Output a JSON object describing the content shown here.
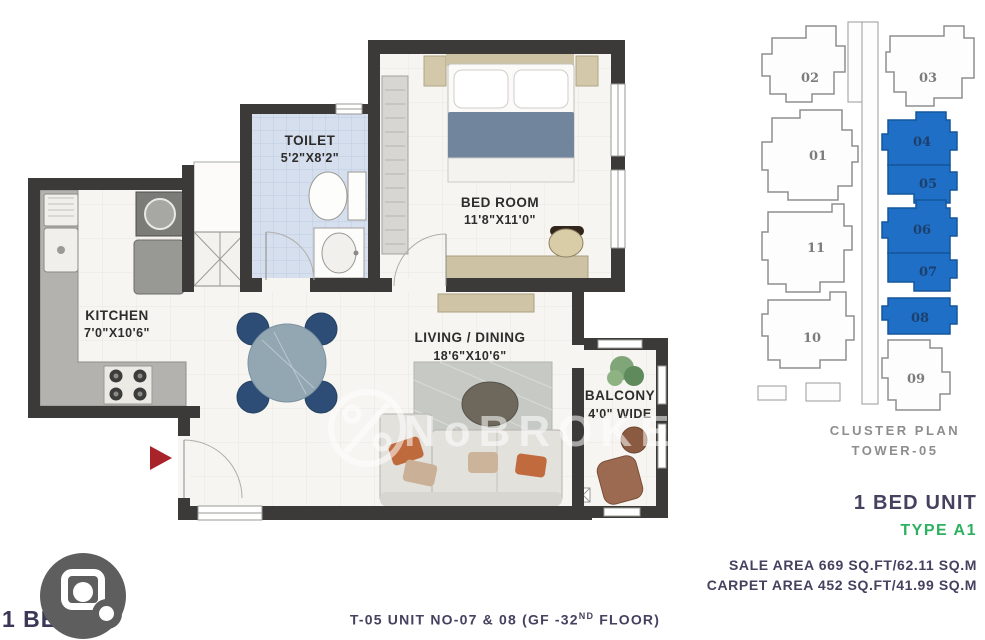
{
  "floorplan": {
    "watermark": "NoBROKER",
    "rooms": [
      {
        "name": "TOILET",
        "dims": "5'2\"X8'2\""
      },
      {
        "name": "BED ROOM",
        "dims": "11'8\"X11'0\""
      },
      {
        "name": "KITCHEN",
        "dims": "7'0\"X10'6\""
      },
      {
        "name": "LIVING / DINING",
        "dims": "18'6\"X10'6\""
      },
      {
        "name": "BALCONY",
        "dims": "4'0\" WIDE"
      }
    ]
  },
  "cluster": {
    "title_line1": "CLUSTER PLAN",
    "title_line2": "TOWER-05",
    "units": [
      {
        "number": "01",
        "highlighted": false
      },
      {
        "number": "02",
        "highlighted": false
      },
      {
        "number": "03",
        "highlighted": false
      },
      {
        "number": "04",
        "highlighted": true
      },
      {
        "number": "05",
        "highlighted": true
      },
      {
        "number": "06",
        "highlighted": true
      },
      {
        "number": "07",
        "highlighted": true
      },
      {
        "number": "08",
        "highlighted": true
      },
      {
        "number": "09",
        "highlighted": false
      },
      {
        "number": "10",
        "highlighted": false
      },
      {
        "number": "11",
        "highlighted": false
      }
    ]
  },
  "details": {
    "unit_type": "1 BED UNIT",
    "type_code": "TYPE A1",
    "sale_area": "SALE AREA 669 SQ.FT/62.11 SQ.M",
    "carpet_area": "CARPET AREA 452 SQ.FT/41.99 SQ.M",
    "footer_prefix": "T-05 UNIT NO-07 & 08 (GF -32",
    "footer_sup": "ND",
    "footer_suffix": " FLOOR)"
  },
  "overlay": {
    "image_label": "1 BED"
  },
  "colors": {
    "unit_highlight_blue": "#1e6fc5",
    "type_green": "#2cb15f",
    "heading_navy": "#45415f",
    "cluster_gray": "#8d8d8d",
    "wall_dark": "#3b3a38",
    "entry_arrow_red": "#a8232a",
    "toilet_floor_blue": "#d5dfee"
  }
}
